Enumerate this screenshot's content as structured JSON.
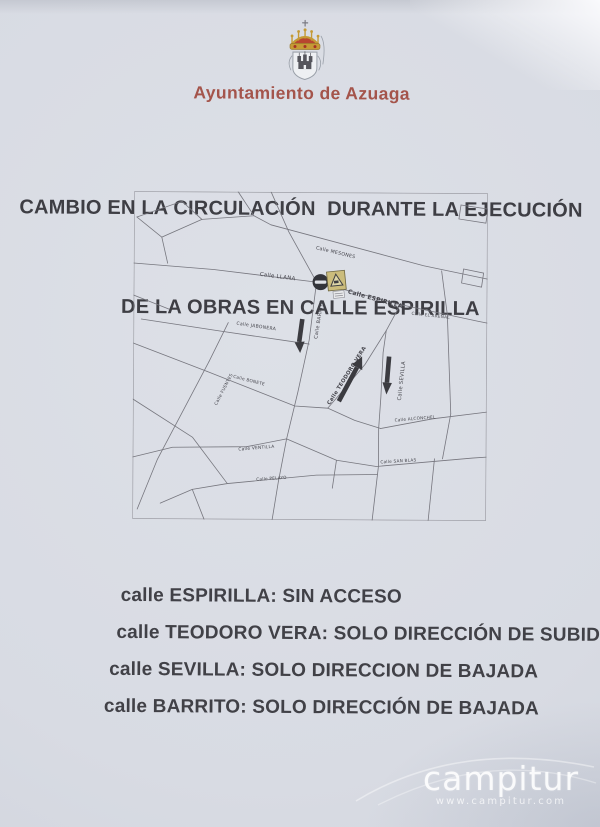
{
  "notice": {
    "municipality": "Ayuntamiento de Azuaga",
    "title_line1": "CAMBIO EN LA CIRCULACIÓN  DURANTE LA EJECUCIÓN",
    "title_line2": "DE LA OBRAS EN CALLE ESPIRILLA"
  },
  "map": {
    "labels": [
      "Calle MESONES",
      "Calle LLANA",
      "Calle ESPIRILLA",
      "Calle JABONERA",
      "Calle BARRITO",
      "Calle EL ARENAL",
      "Calle FUENTES",
      "Calle BONETE",
      "Calle TEODORO VERA",
      "Calle SEVILLA",
      "Calle ALCONCHEL",
      "Calle VENTILLA",
      "Calle PELAYO",
      "Calle SAN BLAS"
    ],
    "signs": [
      {
        "name": "no-entry-sign"
      },
      {
        "name": "roadworks-warning-sign"
      }
    ],
    "arrows": [
      {
        "street": "Calle Barrito",
        "direction": "down"
      },
      {
        "street": "Calle Teodoro Vera",
        "direction": "up"
      },
      {
        "street": "Calle Sevilla",
        "direction": "down"
      }
    ]
  },
  "rules": [
    {
      "text": "calle ESPIRILLA: SIN ACCESO"
    },
    {
      "text": "calle TEODORO VERA: SOLO DIRECCIÓN DE SUBIDA"
    },
    {
      "text": "calle SEVILLA: SOLO DIRECCION DE BAJADA"
    },
    {
      "text": "calle BARRITO: SOLO DIRECCIÓN DE BAJADA"
    }
  ],
  "watermark": {
    "brand": "campitur",
    "url": "www.campitur.com"
  },
  "colors": {
    "accent_red": "#a4544b",
    "ink": "#414147",
    "paper": "#d8dbe3",
    "map_line": "#76767e",
    "warning_yellow": "#cbbc7c",
    "sign_dark": "#33343a"
  }
}
